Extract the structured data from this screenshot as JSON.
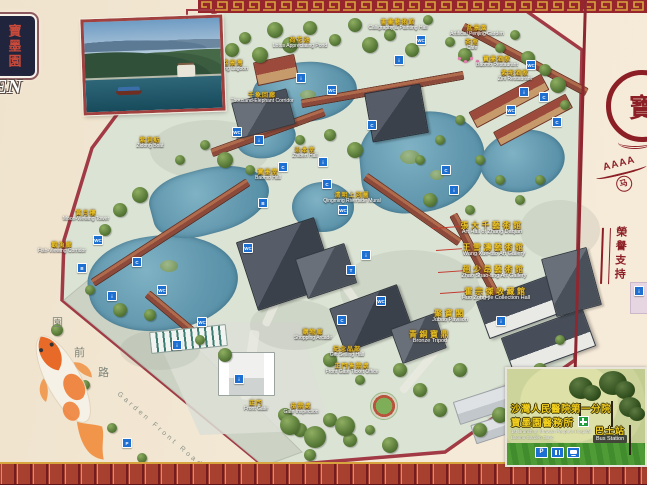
{
  "board": {
    "plaque": {
      "vertical_chars": "寶墨園",
      "english_fragment": "EN"
    },
    "right_panel": {
      "rating_text": "AAAA",
      "horse_char": "马",
      "emblem_char": "寶",
      "vertical_honor_text": "榮譽支持"
    },
    "clinic_inset": {
      "line1_zh": "沙灣人民醫院第一分院",
      "line2_zh": "寶墨園醫務所",
      "line1_en": "1st Branch of Shawan People's Hospital",
      "line2_en": "Baomo Garden Clinic",
      "bus_zh": "巴士站",
      "bus_en": "Bus Station"
    }
  },
  "map": {
    "road": {
      "chars": [
        "園",
        "前",
        "路"
      ],
      "en": "Garden Front Road"
    },
    "labels": [
      {
        "zh": "荷花池",
        "en": "Lotus Appreciating Pond",
        "x": 300,
        "y": 38
      },
      {
        "zh": "書畫藝術館",
        "en": "Calligraphy & Painting Hall",
        "x": 398,
        "y": 20
      },
      {
        "zh": "盆景園",
        "en": "Artificial Penjing Garden",
        "x": 477,
        "y": 26
      },
      {
        "zh": "茶室",
        "en": "Cafe",
        "x": 472,
        "y": 40
      },
      {
        "zh": "寶墨酒家",
        "en": "Baomo Restaurant",
        "x": 497,
        "y": 57
      },
      {
        "zh": "紫坭酒家",
        "en": "Zini Restaurant",
        "x": 515,
        "y": 71
      },
      {
        "zh": "荔景灣",
        "en": "Lijing Lagoon",
        "x": 233,
        "y": 61
      },
      {
        "zh": "千象回廊",
        "en": "Thousand-Elephant Corridor",
        "x": 262,
        "y": 93
      },
      {
        "zh": "紫洞舫",
        "en": "Zidong Boat",
        "x": 150,
        "y": 138
      },
      {
        "zh": "治本堂",
        "en": "Zhiben Hall",
        "x": 305,
        "y": 148
      },
      {
        "zh": "寶墨堂",
        "en": "Baomo Hall",
        "x": 268,
        "y": 170
      },
      {
        "zh": "清明上河圖",
        "en": "Qingming Riverside Mural",
        "x": 352,
        "y": 193
      },
      {
        "zh": "賞月樓",
        "en": "Moon-Viewing Tower",
        "x": 86,
        "y": 211
      },
      {
        "zh": "觀魚廊",
        "en": "Fish-Viewing Corridor",
        "x": 62,
        "y": 243
      },
      {
        "zh": "張大千藝術館",
        "en": "Art Hall of Zhang Daqian",
        "x": 492,
        "y": 222,
        "big": true
      },
      {
        "zh": "王雪濤藝術館",
        "en": "Wang Xue-tao Art Gallery",
        "x": 494,
        "y": 244,
        "big": true
      },
      {
        "zh": "趙少昂藝術館",
        "en": "Zhao Shao-ang Art Gallery",
        "x": 494,
        "y": 266,
        "big": true
      },
      {
        "zh": "霍宗傑收藏館",
        "en": "Huo Zong-jie Collection Hall",
        "x": 496,
        "y": 288,
        "big": true
      },
      {
        "zh": "聚寶閣",
        "en": "Jubao Pavilion",
        "x": 450,
        "y": 310,
        "big": true
      },
      {
        "zh": "青銅寶鼎",
        "en": "Bronze Tripod",
        "x": 430,
        "y": 331,
        "big": true
      },
      {
        "zh": "購物廊",
        "en": "Shopping Arcade",
        "x": 313,
        "y": 330
      },
      {
        "zh": "紀念品部",
        "en": "Gift Selling Hall",
        "x": 347,
        "y": 347
      },
      {
        "zh": "正門售票處",
        "en": "Front Gate Ticket Office",
        "x": 352,
        "y": 364
      },
      {
        "zh": "正門",
        "en": "Front Gate",
        "x": 256,
        "y": 401
      },
      {
        "zh": "檢票處",
        "en": "Gate Inspection",
        "x": 301,
        "y": 404
      }
    ],
    "facility_icons": [
      {
        "name": "toilet-icon",
        "glyph": "WC",
        "x": 236,
        "y": 131
      },
      {
        "name": "info-icon",
        "glyph": "i",
        "x": 258,
        "y": 139
      },
      {
        "name": "photo-icon",
        "glyph": "C",
        "x": 282,
        "y": 166
      },
      {
        "name": "boat-icon",
        "glyph": "B",
        "x": 262,
        "y": 202
      },
      {
        "name": "toilet-icon",
        "glyph": "WC",
        "x": 247,
        "y": 247
      },
      {
        "name": "info-icon",
        "glyph": "i",
        "x": 322,
        "y": 161
      },
      {
        "name": "photo-icon",
        "glyph": "C",
        "x": 326,
        "y": 183
      },
      {
        "name": "toilet-icon",
        "glyph": "WC",
        "x": 342,
        "y": 209
      },
      {
        "name": "info-icon",
        "glyph": "i",
        "x": 365,
        "y": 254
      },
      {
        "name": "tea-icon",
        "glyph": "T",
        "x": 350,
        "y": 269
      },
      {
        "name": "toilet-icon",
        "glyph": "WC",
        "x": 380,
        "y": 300
      },
      {
        "name": "photo-icon",
        "glyph": "C",
        "x": 341,
        "y": 319
      },
      {
        "name": "info-icon",
        "glyph": "i",
        "x": 300,
        "y": 77
      },
      {
        "name": "toilet-icon",
        "glyph": "WC",
        "x": 331,
        "y": 89
      },
      {
        "name": "photo-icon",
        "glyph": "C",
        "x": 371,
        "y": 124
      },
      {
        "name": "info-icon",
        "glyph": "i",
        "x": 398,
        "y": 59
      },
      {
        "name": "toilet-icon",
        "glyph": "WC",
        "x": 420,
        "y": 39
      },
      {
        "name": "photo-icon",
        "glyph": "C",
        "x": 445,
        "y": 169
      },
      {
        "name": "info-icon",
        "glyph": "i",
        "x": 453,
        "y": 189
      },
      {
        "name": "toilet-icon",
        "glyph": "WC",
        "x": 510,
        "y": 109
      },
      {
        "name": "info-icon",
        "glyph": "i",
        "x": 523,
        "y": 91
      },
      {
        "name": "photo-icon",
        "glyph": "C",
        "x": 543,
        "y": 96
      },
      {
        "name": "toilet-icon",
        "glyph": "WC",
        "x": 97,
        "y": 239
      },
      {
        "name": "boat-icon",
        "glyph": "B",
        "x": 81,
        "y": 267
      },
      {
        "name": "info-icon",
        "glyph": "i",
        "x": 111,
        "y": 295
      },
      {
        "name": "photo-icon",
        "glyph": "C",
        "x": 136,
        "y": 261
      },
      {
        "name": "toilet-icon",
        "glyph": "WC",
        "x": 161,
        "y": 289
      },
      {
        "name": "info-icon",
        "glyph": "i",
        "x": 176,
        "y": 344
      },
      {
        "name": "toilet-icon",
        "glyph": "WC",
        "x": 201,
        "y": 321
      },
      {
        "name": "info-icon",
        "glyph": "i",
        "x": 238,
        "y": 378
      },
      {
        "name": "parking-icon",
        "glyph": "P",
        "x": 68,
        "y": 379
      },
      {
        "name": "parking-icon",
        "glyph": "P",
        "x": 126,
        "y": 442
      },
      {
        "name": "toilet-icon",
        "glyph": "WC",
        "x": 530,
        "y": 64
      },
      {
        "name": "photo-icon",
        "glyph": "C",
        "x": 556,
        "y": 121
      },
      {
        "name": "info-icon",
        "glyph": "i",
        "x": 500,
        "y": 320
      }
    ]
  },
  "colors": {
    "accent_red": "#8c1f26",
    "map_border": "#a13a44",
    "water": "#679cb2",
    "label_yellow": "#e8c227",
    "facility_blue": "#1d6fd1",
    "gold": "#d8a43e"
  }
}
